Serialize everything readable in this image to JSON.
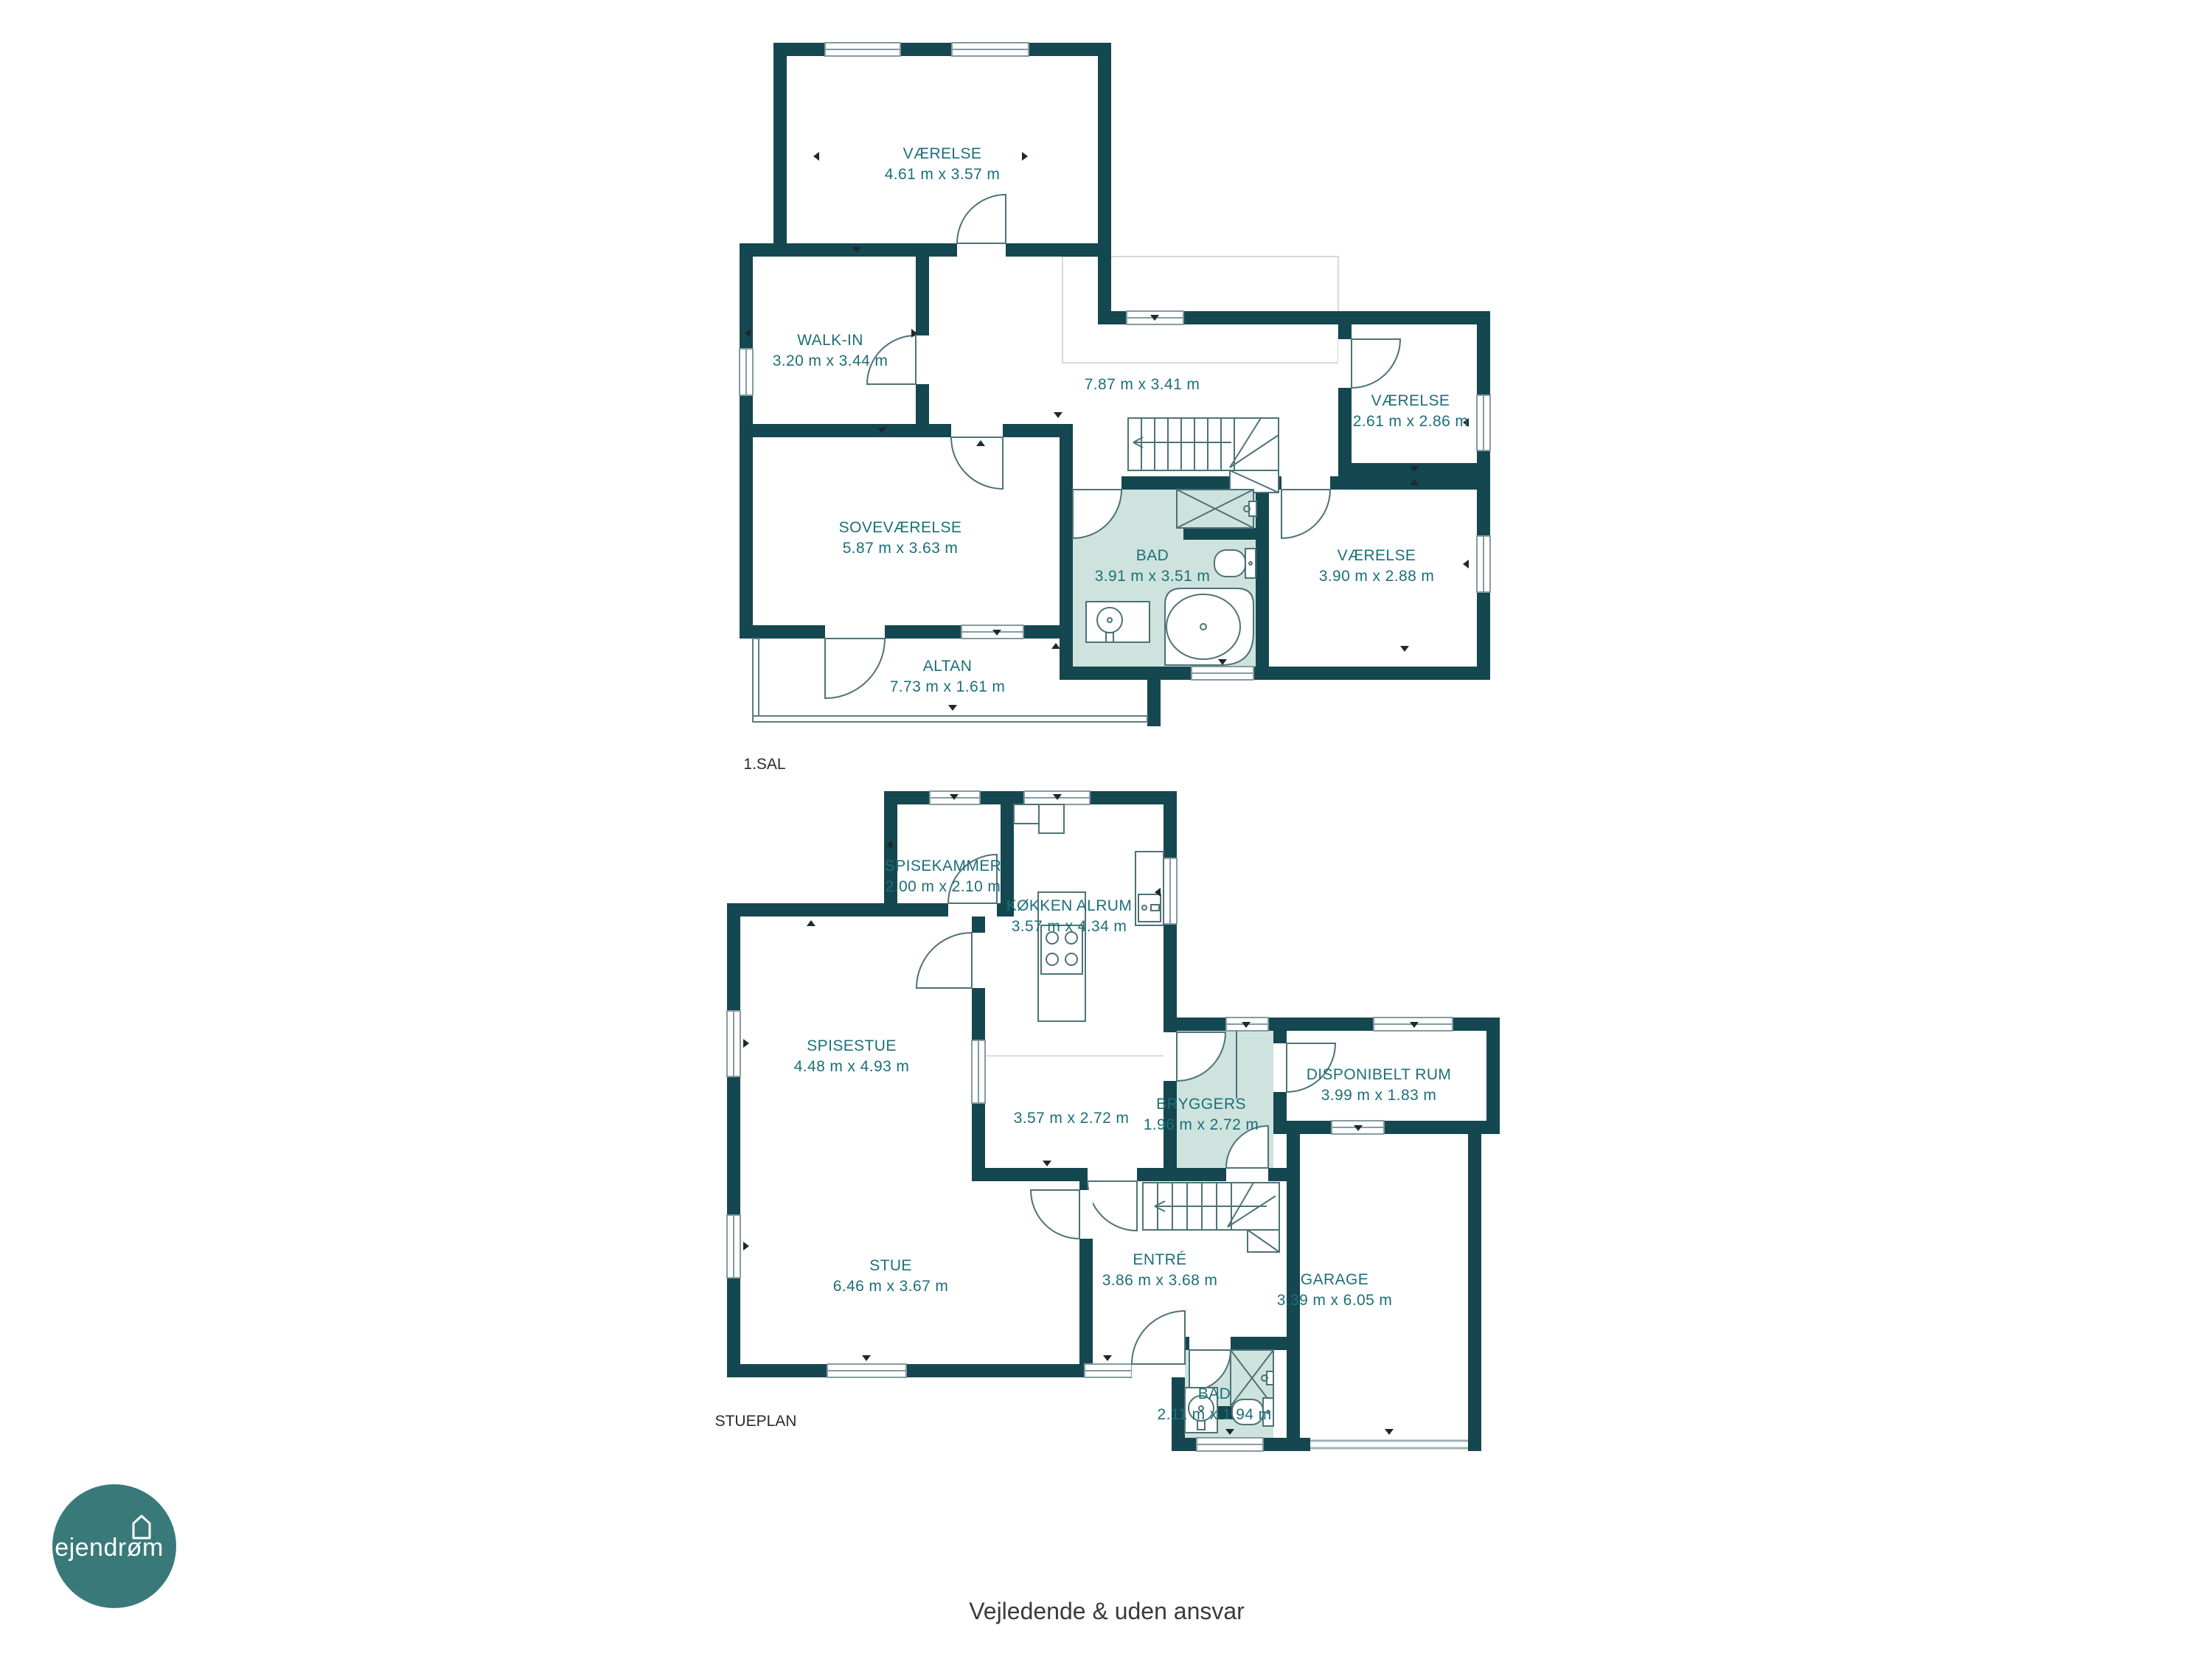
{
  "floors": [
    {
      "label": "1.SAL",
      "rooms": [
        {
          "name": "VÆRELSE",
          "dims": "4.61 m x 3.57 m"
        },
        {
          "name": "WALK-IN",
          "dims": "3.20 m x 3.44 m"
        },
        {
          "name": "",
          "dims": "7.87 m x 3.41 m"
        },
        {
          "name": "VÆRELSE",
          "dims": "2.61 m x 2.86 m"
        },
        {
          "name": "SOVEVÆRELSE",
          "dims": "5.87 m x 3.63 m"
        },
        {
          "name": "BAD",
          "dims": "3.91 m x 3.51 m"
        },
        {
          "name": "VÆRELSE",
          "dims": "3.90 m x 2.88 m"
        },
        {
          "name": "ALTAN",
          "dims": "7.73 m x 1.61 m"
        }
      ]
    },
    {
      "label": "STUEPLAN",
      "rooms": [
        {
          "name": "SPISEKAMMER",
          "dims": "2.00 m x 2.10 m"
        },
        {
          "name": "KØKKEN ALRUM",
          "dims": "3.57 m x 4.34 m"
        },
        {
          "name": "SPISESTUE",
          "dims": "4.48 m x 4.93 m"
        },
        {
          "name": "",
          "dims": "3.57 m x 2.72 m"
        },
        {
          "name": "BRYGGERS",
          "dims": "1.96 m x 2.72 m"
        },
        {
          "name": "DISPONIBELT RUM",
          "dims": "3.99 m x 1.83 m"
        },
        {
          "name": "STUE",
          "dims": "6.46 m x 3.67 m"
        },
        {
          "name": "ENTRÉ",
          "dims": "3.86 m x 3.68 m"
        },
        {
          "name": "GARAGE",
          "dims": "3.39 m x 6.05 m"
        },
        {
          "name": "BAD",
          "dims": "2.11 m x 1.94 m"
        }
      ]
    }
  ],
  "footer": {
    "disclaimer": "Vejledende & uden ansvar"
  },
  "logo": {
    "brand": "ejendrøm"
  },
  "colors": {
    "wall": "#154750",
    "highlight_room_fill": "#cee3dd",
    "room_label_text": "#1c6f7a",
    "floor_label_text": "#2b2b2b",
    "logo_circle": "#3a7979"
  }
}
